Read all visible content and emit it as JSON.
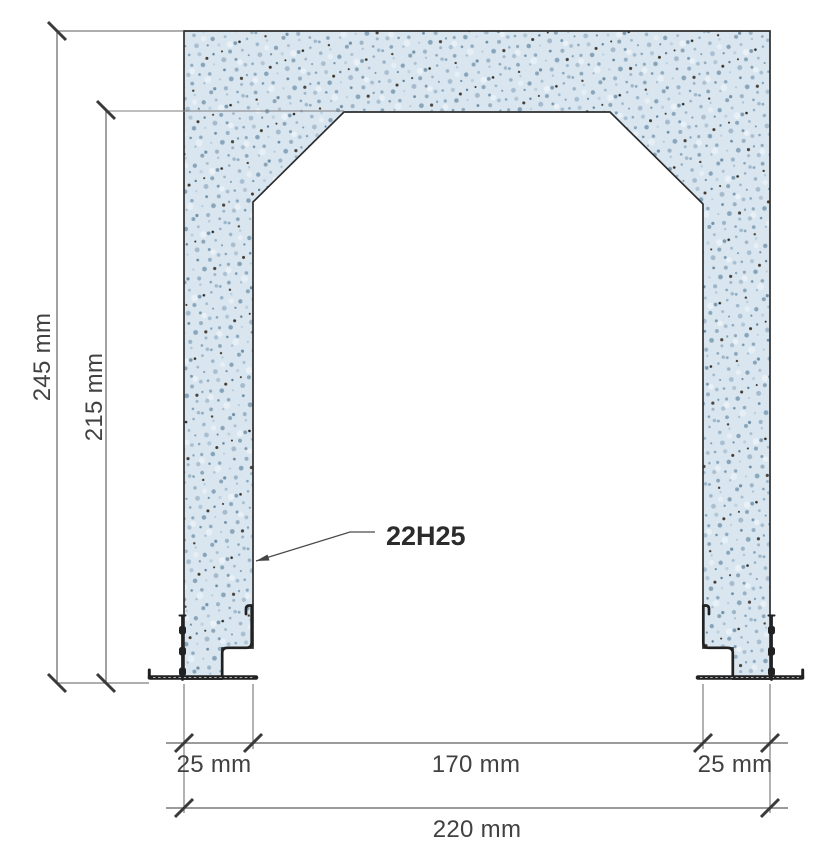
{
  "drawing": {
    "type": "reinforced-concrete-cross-section",
    "dimensions": {
      "total_height": "245 mm",
      "inner_height": "215 mm",
      "wall_left": "25 mm",
      "opening_width": "170 mm",
      "wall_right": "25 mm",
      "total_width": "220 mm"
    },
    "annotation": {
      "rebar": "22H25"
    },
    "colors": {
      "background": "#ffffff",
      "concrete_fill": "#d9e6f0",
      "concrete_outline": "#2d2d2d",
      "dimension_line": "#7a7a7a",
      "tick_mark": "#3a3a3a",
      "label_text": "#414141",
      "annotation_text": "#2b2b2b",
      "steel_detail": "#212121"
    }
  }
}
